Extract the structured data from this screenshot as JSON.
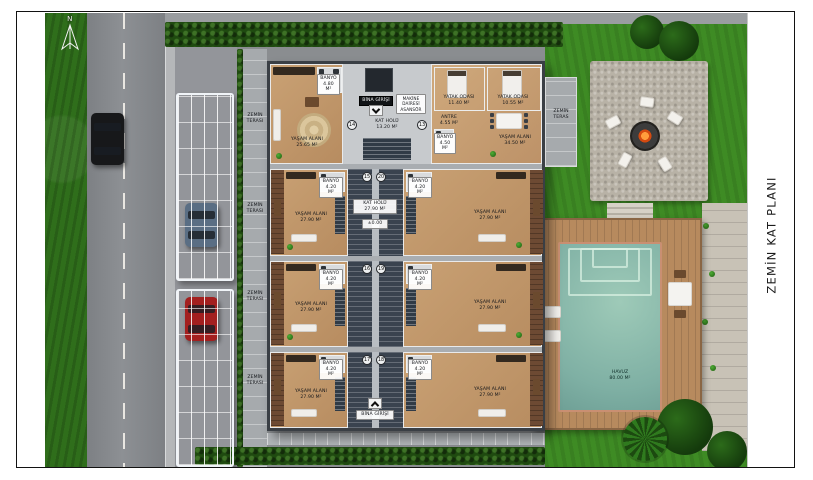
{
  "page": {
    "orientation_label": "N",
    "plan_title": "ZEMİN KAT PLANI"
  },
  "site": {
    "left_terrace_labels": [
      "ZEMİN\nTERASI",
      "ZEMİN\nTERASI",
      "ZEMİN\nTERASI",
      "ZEMİN\nTERASI"
    ],
    "row1_terrace": "ZEMİN\nTERAS",
    "pool": {
      "label": "HAVUZ\n80.00 M²"
    }
  },
  "building": {
    "entrance_top": "BİNA GİRİŞİ",
    "entrance_bottom": "BİNA GİRİŞİ",
    "machine_room": "MAKİNE\nDAİRESİ\nASANSÖR",
    "rows": [
      {
        "left": {
          "living": "YAŞAM ALANI\n25.65 M²",
          "bath": "BANYO\n4.80 M²"
        },
        "core": {
          "no_left": "14",
          "no_right": "13",
          "hall": "KAT HOLÜ\n13.20 M²"
        },
        "right": {
          "bed1": "YATAK ODASI\n11.40 M²",
          "bed2": "YATAK ODASI\n10.55 M²",
          "antre": "ANTRE\n4.55 M²",
          "bath": "BANYO\n4.50 M²",
          "living": "YAŞAM ALANI\n34.50 M²"
        }
      },
      {
        "left": {
          "living": "YAŞAM ALANI\n27.90 M²",
          "bath": "BANYO\n4.20 M²"
        },
        "core": {
          "no_left": "15",
          "no_right": "20",
          "hall": "KAT HOLÜ\n27.90 M²",
          "level": "±0.00"
        },
        "right": {
          "living": "YAŞAM ALANI\n27.90 M²",
          "bath": "BANYO\n4.20 M²"
        }
      },
      {
        "left": {
          "living": "YAŞAM ALANI\n27.90 M²",
          "bath": "BANYO\n4.20 M²"
        },
        "core": {
          "no_left": "16",
          "no_right": "19"
        },
        "right": {
          "living": "YAŞAM ALANI\n27.90 M²",
          "bath": "BANYO\n4.20 M²"
        }
      },
      {
        "left": {
          "living": "YAŞAM ALANI\n27.90 M²",
          "bath": "BANYO\n4.20 M²"
        },
        "core": {
          "no_left": "17",
          "no_right": "18"
        },
        "right": {
          "living": "YAŞAM ALANI\n27.90 M²",
          "bath": "BANYO\n4.20 M²"
        }
      }
    ]
  },
  "colors": {
    "grass": "#2f6e1b",
    "lawn": "#3e8b24",
    "road": "#85878a",
    "wall": "#3a3f45",
    "wood_floor": "#c49a6e",
    "deck": "#b78a5e",
    "pool": "#7fb0a4",
    "black_car": "#17181a",
    "gray_car": "#5a6e84",
    "red_car": "#a31f1f"
  }
}
